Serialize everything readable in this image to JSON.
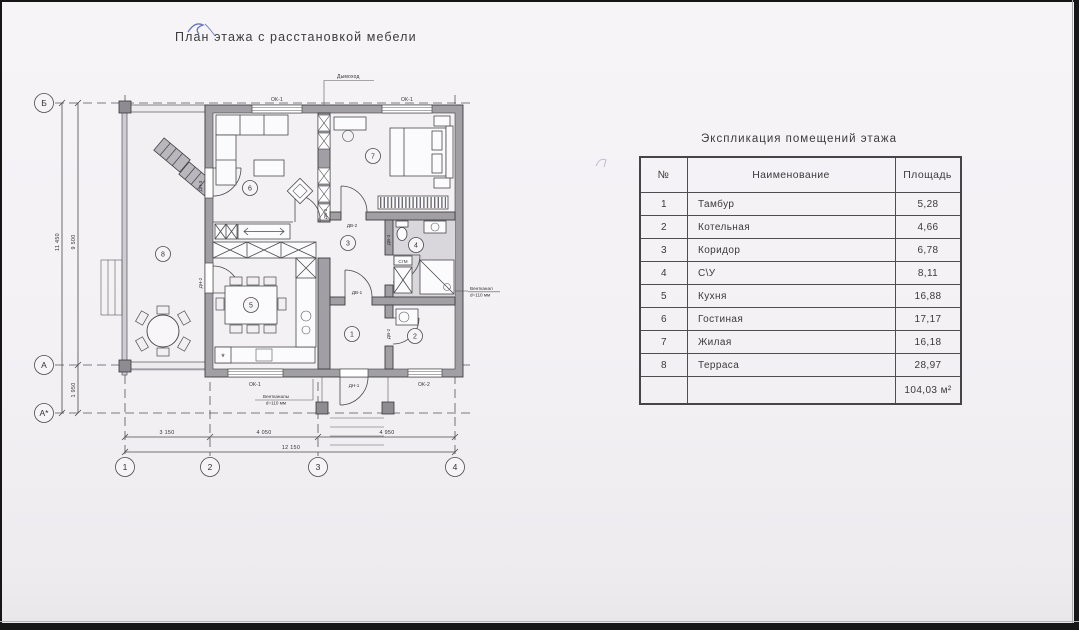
{
  "page": {
    "title": "План этажа с расстановкой мебели"
  },
  "plan": {
    "axes": {
      "row_b": "Б",
      "row_a": "А",
      "row_a1": "А*",
      "col_1": "1",
      "col_2": "2",
      "col_3": "3",
      "col_4": "4"
    },
    "dims": {
      "b1": "3 150",
      "b2": "4 050",
      "b3": "4 950",
      "b_total": "12 150",
      "l_total": "11 450",
      "l1": "9 500",
      "l2": "1 950"
    },
    "labels": {
      "chimney": "Дымоход",
      "window_ok1": "ОК-1",
      "window_ok2": "ОК-2",
      "door_dv1": "ДВ-1",
      "door_dv2": "ДВ-2",
      "door_dv3": "ДВ-3",
      "door_dn1": "ДН-1",
      "door_dn2": "ДН-2",
      "door_dn3": "ДН-3",
      "washer": "СтМ",
      "vent_left_1": "Вентканалы",
      "vent_left_2": "d=110 мм",
      "vent_right_1": "Вентканал",
      "vent_right_2": "d=110 мм",
      "fridge": "*"
    },
    "room_numbers": [
      "1",
      "2",
      "3",
      "4",
      "5",
      "6",
      "7",
      "8"
    ]
  },
  "table": {
    "title": "Экспликация помещений этажа",
    "headers": [
      "№",
      "Наименование",
      "Площадь"
    ],
    "rows": [
      {
        "num": "1",
        "name": "Тамбур",
        "area": "5,28"
      },
      {
        "num": "2",
        "name": "Котельная",
        "area": "4,66"
      },
      {
        "num": "3",
        "name": "Коридор",
        "area": "6,78"
      },
      {
        "num": "4",
        "name": "С\\У",
        "area": "8,11"
      },
      {
        "num": "5",
        "name": "Кухня",
        "area": "16,88"
      },
      {
        "num": "6",
        "name": "Гостиная",
        "area": "17,17"
      },
      {
        "num": "7",
        "name": "Жилая",
        "area": "16,18"
      },
      {
        "num": "8",
        "name": "Терраса",
        "area": "28,97"
      }
    ],
    "total_area": "104,03 м²"
  }
}
